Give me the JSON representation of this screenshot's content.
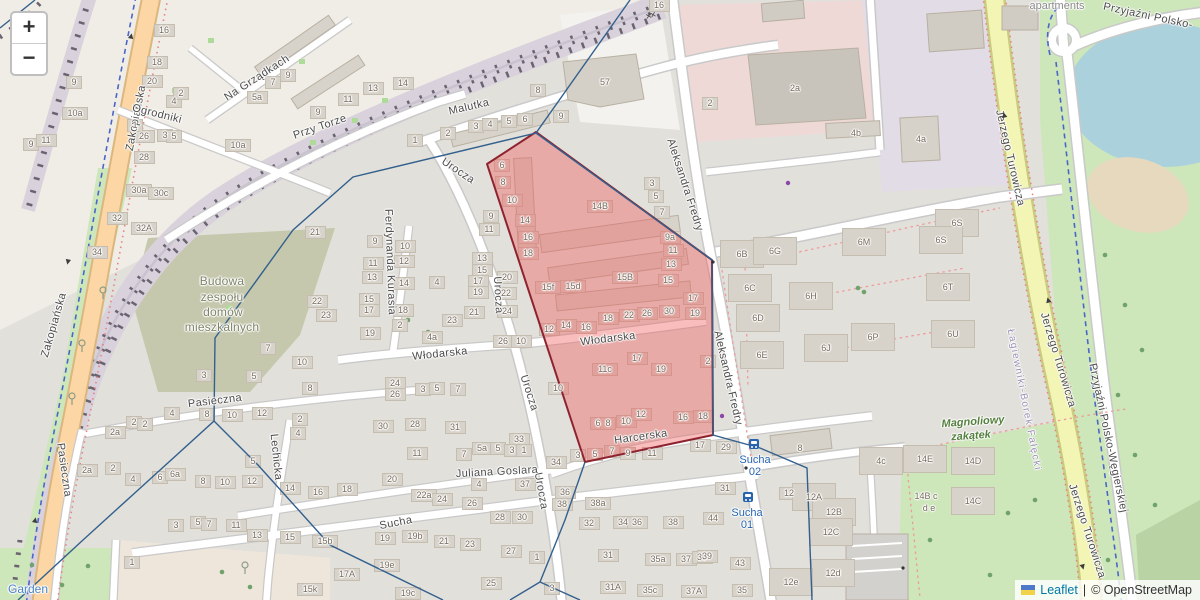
{
  "controls": {
    "zoom_in": "+",
    "zoom_out": "−"
  },
  "attribution": {
    "flag": "ukraine-flag",
    "link_label": "Leaflet",
    "separator": "|",
    "copyright": "© OpenStreetMap"
  },
  "colors": {
    "highlight_fill": "#f05a5a",
    "highlight_stroke": "#8e2330",
    "boundary": "#33608d",
    "road_primary": "#fcd6a4",
    "road_secondary": "#f3f5b5",
    "water": "#abd1dd",
    "park": "#cde6ba",
    "construction_area": "#c6c8ad",
    "transit_blue": "#2864ae",
    "link_blue": "#0078a8"
  },
  "map": {
    "street_labels": [
      {
        "t": "Zakopiańska",
        "x": 136,
        "y": 118,
        "r": -79
      },
      {
        "t": "Zakopiańska",
        "x": 54,
        "y": 325,
        "r": -74
      },
      {
        "t": "Ogrodniki",
        "x": 157,
        "y": 114,
        "r": 14
      },
      {
        "t": "Na Grządkach",
        "x": 257,
        "y": 78,
        "r": -33
      },
      {
        "t": "Przy Torze",
        "x": 320,
        "y": 127,
        "r": -19
      },
      {
        "t": "Malutka",
        "x": 469,
        "y": 107,
        "r": -13
      },
      {
        "t": "Urocza",
        "x": 458,
        "y": 171,
        "r": 34
      },
      {
        "t": "Urocza",
        "x": 498,
        "y": 295,
        "r": 87
      },
      {
        "t": "Urocza",
        "x": 529,
        "y": 393,
        "r": 72
      },
      {
        "t": "Urocza",
        "x": 541,
        "y": 491,
        "r": 80
      },
      {
        "t": "Aleksandra Fredry",
        "x": 685,
        "y": 185,
        "r": 72
      },
      {
        "t": "Aleksandra Fredry",
        "x": 728,
        "y": 378,
        "r": 77
      },
      {
        "t": "Włodarska",
        "x": 608,
        "y": 339,
        "r": -7
      },
      {
        "t": "Włodarska",
        "x": 440,
        "y": 354,
        "r": -6
      },
      {
        "t": "Harcerska",
        "x": 641,
        "y": 437,
        "r": -8
      },
      {
        "t": "Ferdynanda Kurasia",
        "x": 390,
        "y": 262,
        "r": 88
      },
      {
        "t": "Pasieczna",
        "x": 215,
        "y": 401,
        "r": -7
      },
      {
        "t": "Pasieczna",
        "x": 64,
        "y": 470,
        "r": 82
      },
      {
        "t": "Lechicka",
        "x": 276,
        "y": 457,
        "r": 84
      },
      {
        "t": "Juliana Goslara",
        "x": 497,
        "y": 472,
        "r": -3
      },
      {
        "t": "Sucha",
        "x": 396,
        "y": 523,
        "r": -11
      },
      {
        "t": "Jerzego Turowicza",
        "x": 1010,
        "y": 158,
        "r": 77
      },
      {
        "t": "Jerzego Turowicza",
        "x": 1058,
        "y": 360,
        "r": 73
      },
      {
        "t": "Jerzego Turowicza",
        "x": 1087,
        "y": 531,
        "r": 72
      },
      {
        "t": "Przyjaźni Polsko-",
        "x": 1148,
        "y": 16,
        "r": 12
      },
      {
        "t": "Przyjaźni Polsko-Węgierskiej",
        "x": 1108,
        "y": 438,
        "r": 78
      }
    ],
    "area_labels": [
      {
        "t": "Budowa",
        "x": 222,
        "y": 281,
        "c": "construction"
      },
      {
        "t": "zespołu",
        "x": 222,
        "y": 297,
        "c": "construction"
      },
      {
        "t": "domów",
        "x": 223,
        "y": 312,
        "c": "construction"
      },
      {
        "t": "mieszkalnych",
        "x": 222,
        "y": 327,
        "c": "construction"
      },
      {
        "t": "Magnoliowy",
        "x": 973,
        "y": 422,
        "r": -4,
        "c": "park"
      },
      {
        "t": "zakątek",
        "x": 971,
        "y": 436,
        "r": -4,
        "c": "park"
      },
      {
        "t": "apartments",
        "x": 1057,
        "y": 6,
        "c": "place"
      },
      {
        "t": "Garden",
        "x": 28,
        "y": 589,
        "c": "garden"
      },
      {
        "t": "Łagiewniki-Borek Fałęcki",
        "x": 1024,
        "y": 400,
        "r": 79,
        "c": "district"
      }
    ],
    "transit_stops": [
      {
        "name": "Sucha",
        "number": "02",
        "x": 755,
        "y": 466,
        "icon_x": 754,
        "icon_y": 444
      },
      {
        "name": "Sucha",
        "number": "01",
        "x": 747,
        "y": 519,
        "icon_x": 748,
        "icon_y": 497
      }
    ],
    "oneway_arrows": [
      [
        131,
        36,
        -78
      ],
      [
        68,
        262,
        102
      ],
      [
        35,
        520,
        -78
      ],
      [
        1004,
        115,
        -103
      ],
      [
        1048,
        300,
        -105
      ],
      [
        1083,
        567,
        75
      ]
    ],
    "level_crossing": {
      "x": 650,
      "y": 16,
      "glyph": "✕✕"
    },
    "house_numbers": [
      [
        74,
        82,
        "9"
      ],
      [
        31,
        144,
        "9"
      ],
      [
        46,
        140,
        "11"
      ],
      [
        75,
        113,
        "10a"
      ],
      [
        164,
        30,
        "16"
      ],
      [
        157,
        62,
        "18"
      ],
      [
        152,
        81,
        "20"
      ],
      [
        144,
        136,
        "26"
      ],
      [
        144,
        157,
        "28"
      ],
      [
        165,
        135,
        "3"
      ],
      [
        174,
        136,
        "5"
      ],
      [
        135,
        125,
        "1"
      ],
      [
        174,
        101,
        "4"
      ],
      [
        181,
        93,
        "2"
      ],
      [
        139,
        190,
        "30a"
      ],
      [
        161,
        193,
        "30c"
      ],
      [
        117,
        218,
        "32"
      ],
      [
        144,
        228,
        "32A"
      ],
      [
        97,
        252,
        "34"
      ],
      [
        238,
        145,
        "10a"
      ],
      [
        273,
        82,
        "7"
      ],
      [
        288,
        75,
        "9"
      ],
      [
        257,
        97,
        "5a"
      ],
      [
        318,
        112,
        "9"
      ],
      [
        348,
        99,
        "11"
      ],
      [
        373,
        88,
        "13"
      ],
      [
        403,
        83,
        "14"
      ],
      [
        538,
        90,
        "8"
      ],
      [
        659,
        5,
        "16"
      ],
      [
        415,
        140,
        "1"
      ],
      [
        448,
        133,
        "2"
      ],
      [
        476,
        126,
        "3"
      ],
      [
        490,
        124,
        "4"
      ],
      [
        509,
        121,
        "5"
      ],
      [
        525,
        119,
        "6"
      ],
      [
        561,
        116,
        "9"
      ],
      [
        605,
        82,
        "57",
        0
      ],
      [
        710,
        103,
        "2"
      ],
      [
        795,
        88,
        "2a",
        0
      ],
      [
        856,
        133,
        "4b",
        0
      ],
      [
        921,
        139,
        "4a",
        0
      ],
      [
        315,
        232,
        "21"
      ],
      [
        317,
        301,
        "22"
      ],
      [
        326,
        315,
        "23"
      ],
      [
        375,
        241,
        "9"
      ],
      [
        405,
        246,
        "10"
      ],
      [
        373,
        263,
        "11"
      ],
      [
        404,
        261,
        "12"
      ],
      [
        372,
        277,
        "13"
      ],
      [
        404,
        283,
        "14"
      ],
      [
        369,
        299,
        "15"
      ],
      [
        369,
        310,
        "17"
      ],
      [
        403,
        310,
        "18"
      ],
      [
        400,
        325,
        "2"
      ],
      [
        370,
        333,
        "19"
      ],
      [
        437,
        282,
        "4"
      ],
      [
        452,
        320,
        "23"
      ],
      [
        432,
        337,
        "4a"
      ],
      [
        491,
        216,
        "9"
      ],
      [
        489,
        229,
        "11"
      ],
      [
        482,
        258,
        "13"
      ],
      [
        482,
        270,
        "15"
      ],
      [
        478,
        281,
        "17"
      ],
      [
        478,
        292,
        "19"
      ],
      [
        474,
        312,
        "21"
      ],
      [
        507,
        277,
        "20"
      ],
      [
        506,
        293,
        "22"
      ],
      [
        507,
        311,
        "24"
      ],
      [
        503,
        341,
        "26"
      ],
      [
        521,
        341,
        "10"
      ],
      [
        502,
        165,
        "6"
      ],
      [
        503,
        182,
        "8"
      ],
      [
        512,
        200,
        "10"
      ],
      [
        525,
        220,
        "14"
      ],
      [
        528,
        237,
        "16"
      ],
      [
        528,
        253,
        "18"
      ],
      [
        600,
        206,
        "14B"
      ],
      [
        625,
        277,
        "15B"
      ],
      [
        573,
        286,
        "15d"
      ],
      [
        548,
        287,
        "15f"
      ],
      [
        549,
        329,
        "12"
      ],
      [
        566,
        325,
        "14"
      ],
      [
        586,
        327,
        "16"
      ],
      [
        608,
        318,
        "18"
      ],
      [
        629,
        315,
        "22"
      ],
      [
        647,
        313,
        "26"
      ],
      [
        669,
        311,
        "30"
      ],
      [
        670,
        237,
        "9a"
      ],
      [
        673,
        250,
        "11"
      ],
      [
        671,
        264,
        "13"
      ],
      [
        668,
        280,
        "15"
      ],
      [
        693,
        298,
        "17"
      ],
      [
        695,
        313,
        "19"
      ],
      [
        605,
        369,
        "11c"
      ],
      [
        637,
        358,
        "17"
      ],
      [
        661,
        369,
        "19"
      ],
      [
        708,
        361,
        "2"
      ],
      [
        558,
        388,
        "10"
      ],
      [
        598,
        423,
        "6"
      ],
      [
        608,
        423,
        "8"
      ],
      [
        626,
        421,
        "10"
      ],
      [
        641,
        414,
        "12"
      ],
      [
        683,
        417,
        "16"
      ],
      [
        703,
        416,
        "18"
      ],
      [
        652,
        183,
        "3"
      ],
      [
        656,
        196,
        "5"
      ],
      [
        662,
        212,
        "7"
      ],
      [
        742,
        254,
        "6B"
      ],
      [
        750,
        288,
        "6C"
      ],
      [
        758,
        318,
        "6D"
      ],
      [
        762,
        355,
        "6E"
      ],
      [
        775,
        251,
        "6G"
      ],
      [
        811,
        296,
        "6H"
      ],
      [
        864,
        242,
        "6M"
      ],
      [
        957,
        223,
        "6S"
      ],
      [
        941,
        240,
        "6S"
      ],
      [
        948,
        287,
        "6T"
      ],
      [
        873,
        337,
        "6P"
      ],
      [
        826,
        348,
        "6J"
      ],
      [
        953,
        334,
        "6U"
      ],
      [
        268,
        348,
        "7"
      ],
      [
        302,
        362,
        "10"
      ],
      [
        204,
        375,
        "3"
      ],
      [
        254,
        376,
        "5"
      ],
      [
        310,
        388,
        "8"
      ],
      [
        395,
        383,
        "24"
      ],
      [
        395,
        394,
        "26"
      ],
      [
        423,
        389,
        "3"
      ],
      [
        437,
        388,
        "5"
      ],
      [
        458,
        389,
        "7"
      ],
      [
        172,
        413,
        "4"
      ],
      [
        207,
        414,
        "8"
      ],
      [
        232,
        415,
        "10"
      ],
      [
        262,
        413,
        "12"
      ],
      [
        300,
        419,
        "2"
      ],
      [
        134,
        422,
        "2"
      ],
      [
        115,
        432,
        "2a"
      ],
      [
        145,
        424,
        "2"
      ],
      [
        298,
        433,
        "4"
      ],
      [
        87,
        470,
        "2a"
      ],
      [
        113,
        468,
        "2"
      ],
      [
        133,
        479,
        "4"
      ],
      [
        160,
        477,
        "6"
      ],
      [
        175,
        474,
        "6a"
      ],
      [
        203,
        481,
        "8"
      ],
      [
        225,
        482,
        "10"
      ],
      [
        252,
        481,
        "12"
      ],
      [
        253,
        461,
        "5"
      ],
      [
        383,
        426,
        "30"
      ],
      [
        415,
        424,
        "28"
      ],
      [
        455,
        427,
        "31"
      ],
      [
        519,
        439,
        "33"
      ],
      [
        417,
        453,
        "11"
      ],
      [
        464,
        454,
        "7"
      ],
      [
        482,
        448,
        "5a"
      ],
      [
        498,
        448,
        "5"
      ],
      [
        512,
        450,
        "3"
      ],
      [
        524,
        450,
        "1"
      ],
      [
        392,
        479,
        "20"
      ],
      [
        479,
        484,
        "4"
      ],
      [
        525,
        484,
        "37"
      ],
      [
        424,
        495,
        "22a"
      ],
      [
        442,
        499,
        "24"
      ],
      [
        472,
        503,
        "26"
      ],
      [
        500,
        517,
        "28"
      ],
      [
        522,
        517,
        "30"
      ],
      [
        290,
        488,
        "14"
      ],
      [
        318,
        492,
        "16"
      ],
      [
        347,
        489,
        "18"
      ],
      [
        290,
        537,
        "15"
      ],
      [
        325,
        541,
        "15b"
      ],
      [
        385,
        538,
        "19"
      ],
      [
        415,
        536,
        "19b"
      ],
      [
        444,
        541,
        "21"
      ],
      [
        470,
        544,
        "23"
      ],
      [
        511,
        551,
        "27"
      ],
      [
        537,
        557,
        "1"
      ],
      [
        387,
        565,
        "19e"
      ],
      [
        347,
        574,
        "17A"
      ],
      [
        310,
        589,
        "15k"
      ],
      [
        408,
        593,
        "19c"
      ],
      [
        491,
        583,
        "25"
      ],
      [
        552,
        588,
        "3"
      ],
      [
        176,
        525,
        "3"
      ],
      [
        198,
        522,
        "5"
      ],
      [
        209,
        524,
        "7"
      ],
      [
        236,
        525,
        "11"
      ],
      [
        257,
        535,
        "13"
      ],
      [
        556,
        462,
        "34"
      ],
      [
        565,
        492,
        "36"
      ],
      [
        562,
        504,
        "38"
      ],
      [
        598,
        503,
        "38a"
      ],
      [
        589,
        523,
        "32"
      ],
      [
        623,
        522,
        "34"
      ],
      [
        637,
        522,
        "36"
      ],
      [
        673,
        522,
        "38"
      ],
      [
        608,
        555,
        "31"
      ],
      [
        658,
        559,
        "35a"
      ],
      [
        686,
        559,
        "37"
      ],
      [
        702,
        557,
        "39"
      ],
      [
        613,
        587,
        "31A"
      ],
      [
        650,
        590,
        "35c"
      ],
      [
        694,
        591,
        "37A"
      ],
      [
        578,
        455,
        "3"
      ],
      [
        595,
        454,
        "5"
      ],
      [
        612,
        451,
        "7"
      ],
      [
        628,
        453,
        "9"
      ],
      [
        652,
        453,
        "11"
      ],
      [
        700,
        445,
        "17"
      ],
      [
        726,
        447,
        "29"
      ],
      [
        800,
        448,
        "8",
        0
      ],
      [
        881,
        461,
        "4c"
      ],
      [
        925,
        459,
        "14E"
      ],
      [
        973,
        461,
        "14D"
      ],
      [
        926,
        496,
        "14B c",
        0
      ],
      [
        929,
        508,
        "d e",
        0
      ],
      [
        973,
        501,
        "14C"
      ],
      [
        789,
        493,
        "12"
      ],
      [
        814,
        497,
        "12A"
      ],
      [
        834,
        512,
        "12B"
      ],
      [
        831,
        532,
        "12C"
      ],
      [
        833,
        573,
        "12d"
      ],
      [
        791,
        582,
        "12e"
      ],
      [
        725,
        488,
        "31"
      ],
      [
        713,
        518,
        "44"
      ],
      [
        707,
        556,
        "39"
      ],
      [
        740,
        563,
        "43"
      ],
      [
        742,
        590,
        "35"
      ],
      [
        132,
        562,
        "1"
      ]
    ]
  }
}
